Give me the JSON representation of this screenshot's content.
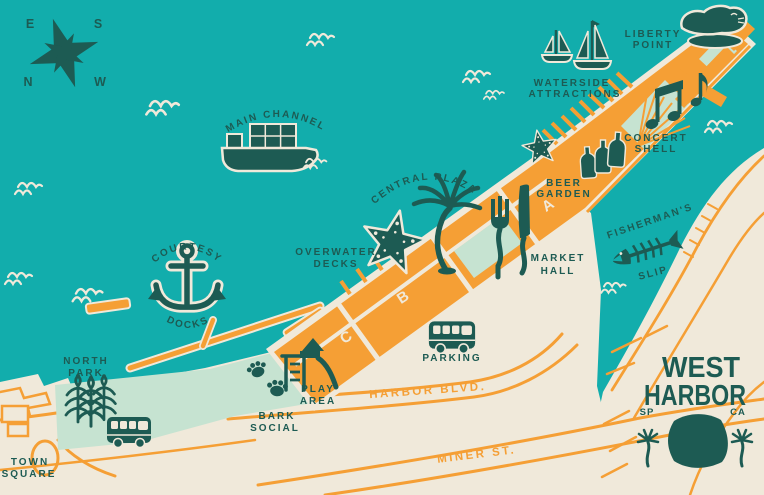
{
  "map_title": "West Harbor illustrated map",
  "colors": {
    "water": "#12adac",
    "land": "#f0e9da",
    "mint": "#c6e3d1",
    "orange": "#f59f35",
    "ink": "#1d5b53"
  },
  "compass": {
    "e": "E",
    "s": "S",
    "n": "N",
    "w": "W"
  },
  "water_features": {
    "main_channel": "MAIN CHANNEL",
    "courtesy": "COURTESY",
    "docks": "DOCKS",
    "central_plaza": "CENTRAL PLAZA",
    "fishermans": "FISHERMAN'S",
    "slip": "SLIP"
  },
  "places": {
    "liberty_point": [
      "LIBERTY",
      "POINT"
    ],
    "waterside_attractions": [
      "WATERSIDE",
      "ATTRACTIONS"
    ],
    "concert_shell": [
      "CONCERT",
      "SHELL"
    ],
    "beer_garden": [
      "BEER",
      "GARDEN"
    ],
    "market_hall": [
      "MARKET",
      "HALL"
    ],
    "overwater_decks": [
      "OVERWATER",
      "DECKS"
    ],
    "north_park": [
      "NORTH",
      "PARK"
    ],
    "town_square": [
      "TOWN",
      "SQUARE"
    ],
    "bark_social": [
      "BARK",
      "SOCIAL"
    ],
    "play_area": [
      "PLAY",
      "AREA"
    ],
    "parking": "PARKING"
  },
  "roads": {
    "harbor_blvd": "HARBOR BLVD.",
    "miner_st": "MINER ST."
  },
  "buildings": {
    "a": "A",
    "b": "B",
    "c": "C"
  },
  "logo": {
    "word1": "WEST",
    "word2": "HARBOR",
    "left": "SP",
    "right": "CA"
  },
  "icons": [
    "compass-rose-icon",
    "cargo-ship-icon",
    "sailboat-icon",
    "anchor-icon",
    "starfish-icon",
    "palm-tree-icon",
    "fork-knife-icon",
    "beer-bottles-icon",
    "music-notes-icon",
    "fish-bone-icon",
    "sea-lion-icon",
    "vw-bus-icon",
    "playground-icon",
    "paw-print-icon",
    "plant-icon",
    "wave-icon",
    "west-harbor-logo"
  ]
}
